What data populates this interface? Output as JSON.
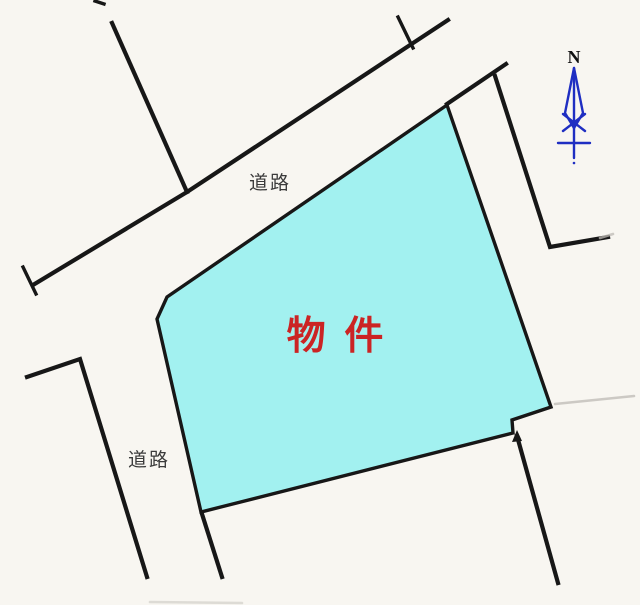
{
  "labels": {
    "road_upper": "道路",
    "road_lower": "道路",
    "property": "物 件",
    "north": "N"
  },
  "colors": {
    "background": "#f8f6f1",
    "parcel_fill": "#a2f1f0",
    "line_color": "#171717",
    "faint_line": "#bdbab4",
    "property_text": "#cb2424",
    "road_text": "#3b3b3b",
    "north_arrow": "#1f2ec2",
    "north_text": "#101010"
  }
}
